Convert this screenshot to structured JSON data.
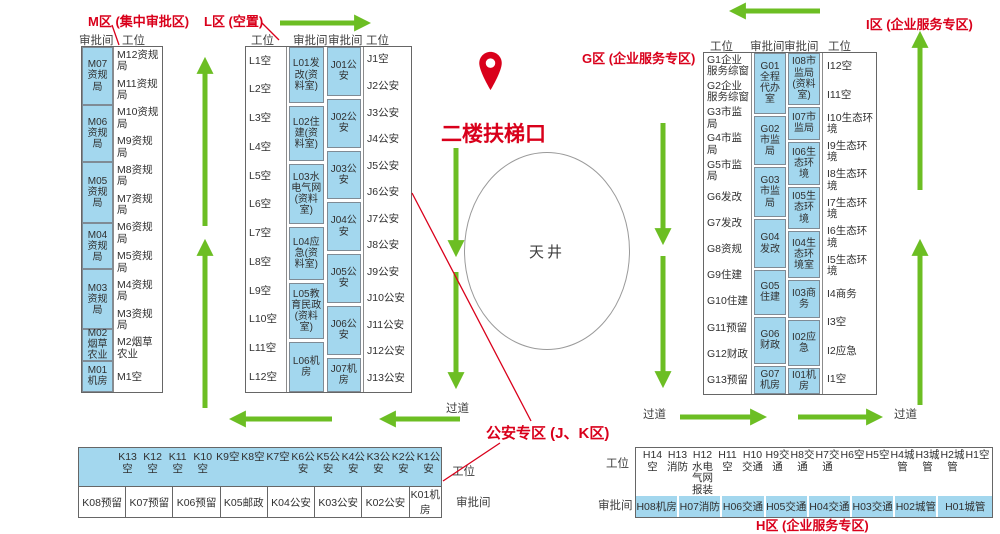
{
  "labels": {
    "zone_m": "M区 (集中审批区)",
    "zone_l": "L区 (空置)",
    "zone_g": "G区 (企业服务专区)",
    "zone_i": "I区 (企业服务专区)",
    "zone_jk": "公安专区 (J、K区)",
    "zone_h": "H区 (企业服务专区)",
    "escalator": "二楼扶梯口",
    "atrium": "天井",
    "aisle": "过道",
    "booth_header": "审批间",
    "workstation_header": "工位"
  },
  "icons": {
    "escalator_pin": "map-pin"
  },
  "colors": {
    "accent_red": "#d9001b",
    "cell_blue": "#a3d7ee",
    "arrow_green": "#6cbe23",
    "border_gray": "#666666"
  },
  "m_block": {
    "booths": [
      {
        "label": "M07资规局",
        "h": 59
      },
      {
        "label": "M06资规局",
        "h": 58
      },
      {
        "label": "M05资规局",
        "h": 63
      },
      {
        "label": "M04资规局",
        "h": 46
      },
      {
        "label": "M03资规局",
        "h": 61
      },
      {
        "label": "M02烟草农业",
        "h": 30
      },
      {
        "label": "M01机房",
        "h": 30
      }
    ],
    "workstations": [
      "M12资规局",
      "M11资规局",
      "M10资规局",
      "M9资规局",
      "M8资规局",
      "M7资规局",
      "M6资规局",
      "M5资规局",
      "M4资规局",
      "M3资规局",
      "M2烟草农业",
      "M1空"
    ]
  },
  "lj_block": {
    "l_workstations": [
      "L1空",
      "L2空",
      "L3空",
      "L4空",
      "L5空",
      "L6空",
      "L7空",
      "L8空",
      "L9空",
      "L10空",
      "L11空",
      "L12空"
    ],
    "l_booths": [
      {
        "label": "L01发改(资料室)",
        "h": 57
      },
      {
        "label": "L02住建(资料室)",
        "h": 55
      },
      {
        "label": "L03水电气网(资料室)",
        "h": 62
      },
      {
        "label": "L04应急(资料室)",
        "h": 53
      },
      {
        "label": "L05教育民政(资料室)",
        "h": 57
      },
      {
        "label": "L06机房",
        "h": 50
      }
    ],
    "j_booths": [
      {
        "label": "J01公安",
        "h": 50
      },
      {
        "label": "J02公安",
        "h": 50
      },
      {
        "label": "J03公安",
        "h": 50
      },
      {
        "label": "J04公安",
        "h": 50
      },
      {
        "label": "J05公安",
        "h": 50
      },
      {
        "label": "J06公安",
        "h": 50
      },
      {
        "label": "J07机房",
        "h": 34
      }
    ],
    "j_workstations": [
      "J1空",
      "J2公安",
      "J3公安",
      "J4公安",
      "J5公安",
      "J6公安",
      "J7公安",
      "J8公安",
      "J9公安",
      "J10公安",
      "J11公安",
      "J12公安",
      "J13公安"
    ]
  },
  "gi_block": {
    "g_workstations": [
      "G1企业服务综窗",
      "G2企业服务综窗",
      "G3市监局",
      "G4市监局",
      "G5市监局",
      "G6发改",
      "G7发改",
      "G8资规",
      "G9住建",
      "G10住建",
      "G11预留",
      "G12财政",
      "G13预留"
    ],
    "g_booths": [
      {
        "label": "G01全程代办室",
        "h": 62
      },
      {
        "label": "G02市监局",
        "h": 50
      },
      {
        "label": "G03市监局",
        "h": 50
      },
      {
        "label": "G04发改",
        "h": 50
      },
      {
        "label": "G05住建",
        "h": 44
      },
      {
        "label": "G06财政",
        "h": 48
      },
      {
        "label": "G07机房",
        "h": 26
      }
    ],
    "i_booths": [
      {
        "label": "I08市监局(资料室)",
        "h": 53
      },
      {
        "label": "I07市监局",
        "h": 33
      },
      {
        "label": "I06生态环境",
        "h": 43
      },
      {
        "label": "I05生态环境",
        "h": 43
      },
      {
        "label": "I04生态环境室",
        "h": 48
      },
      {
        "label": "I03商务",
        "h": 38
      },
      {
        "label": "I02应急",
        "h": 46
      },
      {
        "label": "I01机房",
        "h": 25
      }
    ],
    "i_workstations": [
      "I12空",
      "I11空",
      "I10生态环境",
      "I9生态环境",
      "I8生态环境",
      "I7生态环境",
      "I6生态环境",
      "I5生态环境",
      "I4商务",
      "I3空",
      "I2应急",
      "I1空"
    ]
  },
  "k_block": {
    "workstations": [
      "K13空",
      "K12空",
      "K11空",
      "K10空",
      "K9空",
      "K8空",
      "K7空",
      "K6公安",
      "K5公安",
      "K4公安",
      "K3公安",
      "K2公安",
      "K1公安"
    ],
    "booths": [
      "K08预留",
      "K07预留",
      "K06预留",
      "K05邮政",
      "K04公安",
      "K03公安",
      "K02公安",
      "K01机房"
    ]
  },
  "h_block": {
    "workstations": [
      "H14空",
      "H13消防",
      "H12水电气网报装",
      "H11空",
      "H10交通",
      "H9交通",
      "H8交通",
      "H7交通",
      "H6空",
      "H5空",
      "H4城管",
      "H3城管",
      "H2城管",
      "H1空"
    ],
    "booths": [
      "H08机房",
      "H07消防",
      "H06交通",
      "H05交通",
      "H04交通",
      "H03交通",
      "H02城管",
      "H01城管"
    ]
  }
}
